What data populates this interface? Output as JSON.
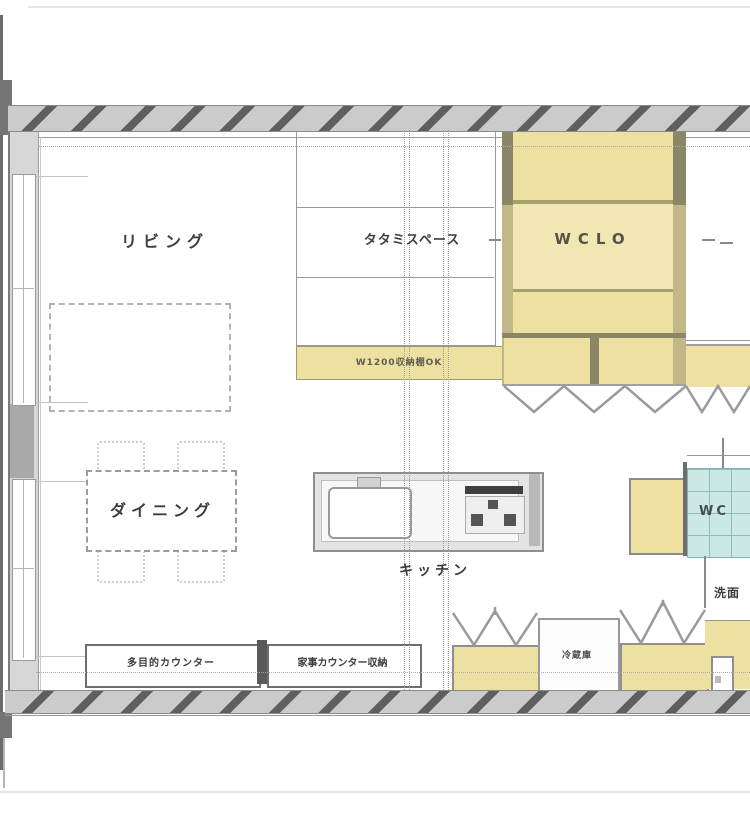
{
  "plan": {
    "title": "LDK floor plan",
    "rooms": {
      "living": {
        "label": "リビング"
      },
      "tatami": {
        "label": "タタミスペース"
      },
      "wclo": {
        "label": "WCLO"
      },
      "dining": {
        "label": "ダイニング"
      },
      "kitchen": {
        "label": "キッチン"
      },
      "wc": {
        "label": "WC"
      },
      "washroom": {
        "label": "洗面"
      }
    },
    "fixtures": {
      "storage_shelf": {
        "label": "W1200収納棚OK"
      },
      "multi_counter": {
        "label": "多目的カウンター"
      },
      "work_counter": {
        "label": "家事カウンター収納"
      },
      "refrigerator": {
        "label": "冷蔵庫"
      }
    },
    "colors": {
      "closet_fill": "#ede0a0",
      "closet_fill_light": "#f1e7b2",
      "tile_fill": "#cbe8e4",
      "wall_band": "#cbcbcb",
      "pillar_dark": "#8c8669",
      "pillar_light": "#c2b887"
    }
  }
}
